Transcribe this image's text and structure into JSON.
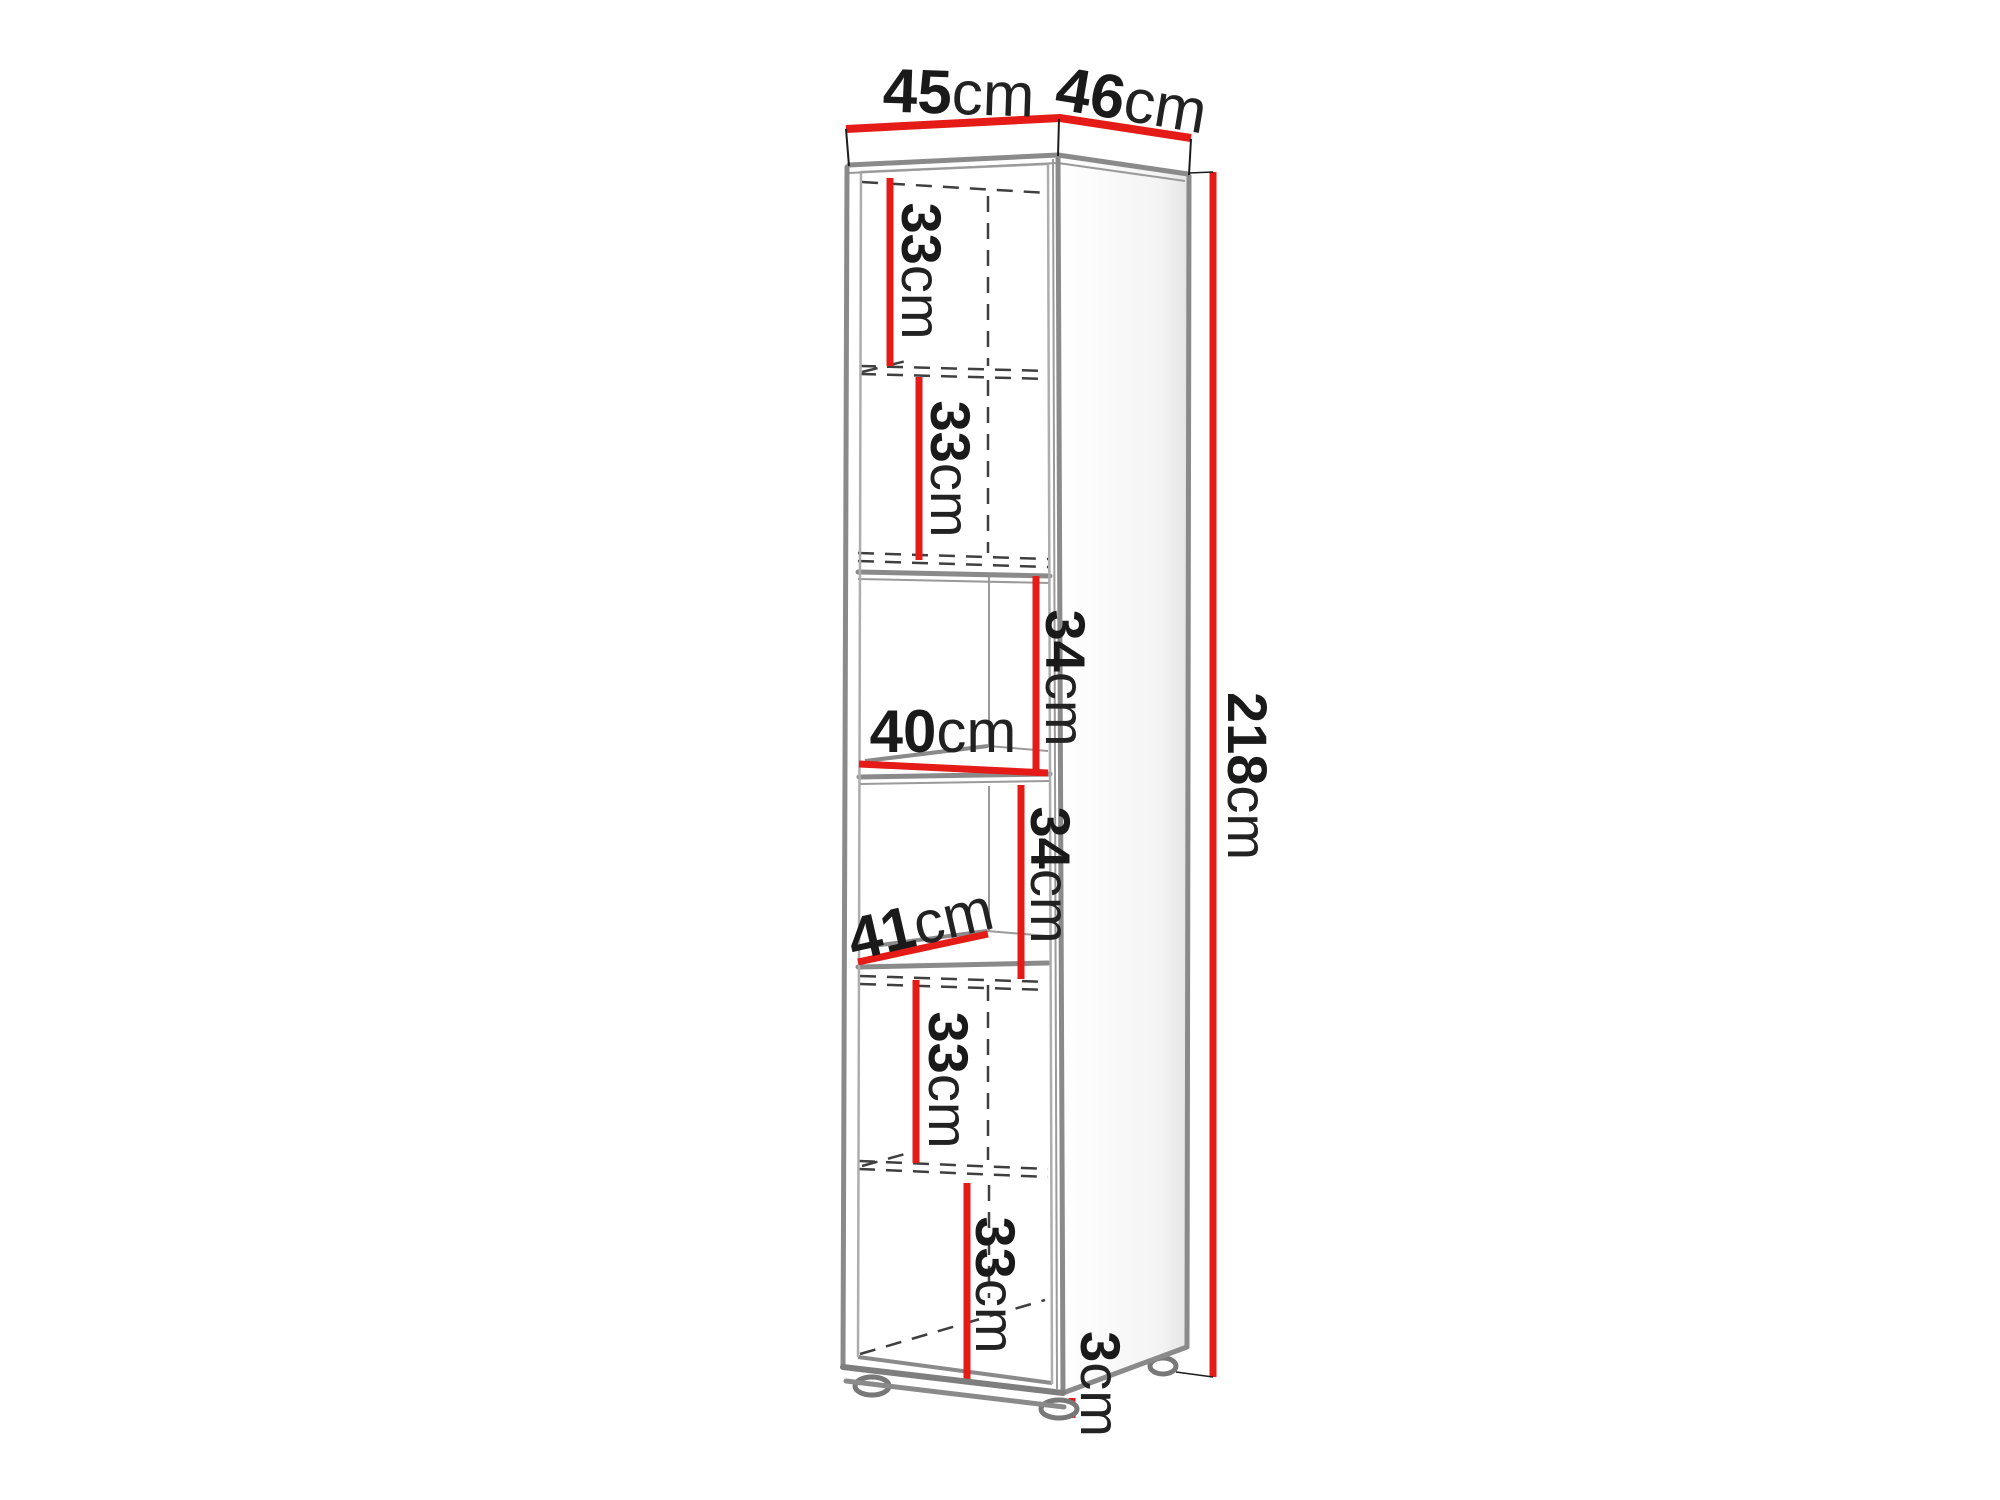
{
  "diagram": {
    "type": "furniture-dimension-diagram",
    "subject": "tall narrow shelf cabinet shown in 3D perspective with dimension lines",
    "unit": "cm",
    "colors": {
      "dimension_line": "#e41b17",
      "cabinet_edge": "#8a8a8a",
      "hidden_line": "#3f3f3f",
      "text": "#1a1a1a",
      "background": "#ffffff"
    },
    "dimensions": {
      "top_width": {
        "num": "45",
        "unit": "cm"
      },
      "top_depth": {
        "num": "46",
        "unit": "cm"
      },
      "total_height": {
        "num": "218",
        "unit": "cm"
      },
      "compartment_1_height": {
        "num": "33",
        "unit": "cm"
      },
      "compartment_2_height": {
        "num": "33",
        "unit": "cm"
      },
      "niche_upper_height": {
        "num": "34",
        "unit": "cm"
      },
      "niche_upper_depth": {
        "num": "40",
        "unit": "cm"
      },
      "niche_lower_height": {
        "num": "34",
        "unit": "cm"
      },
      "niche_lower_depth": {
        "num": "41",
        "unit": "cm"
      },
      "compartment_5_height": {
        "num": "33",
        "unit": "cm"
      },
      "compartment_6_height": {
        "num": "33",
        "unit": "cm"
      },
      "foot_height": {
        "num": "3",
        "unit": "cm"
      }
    }
  }
}
